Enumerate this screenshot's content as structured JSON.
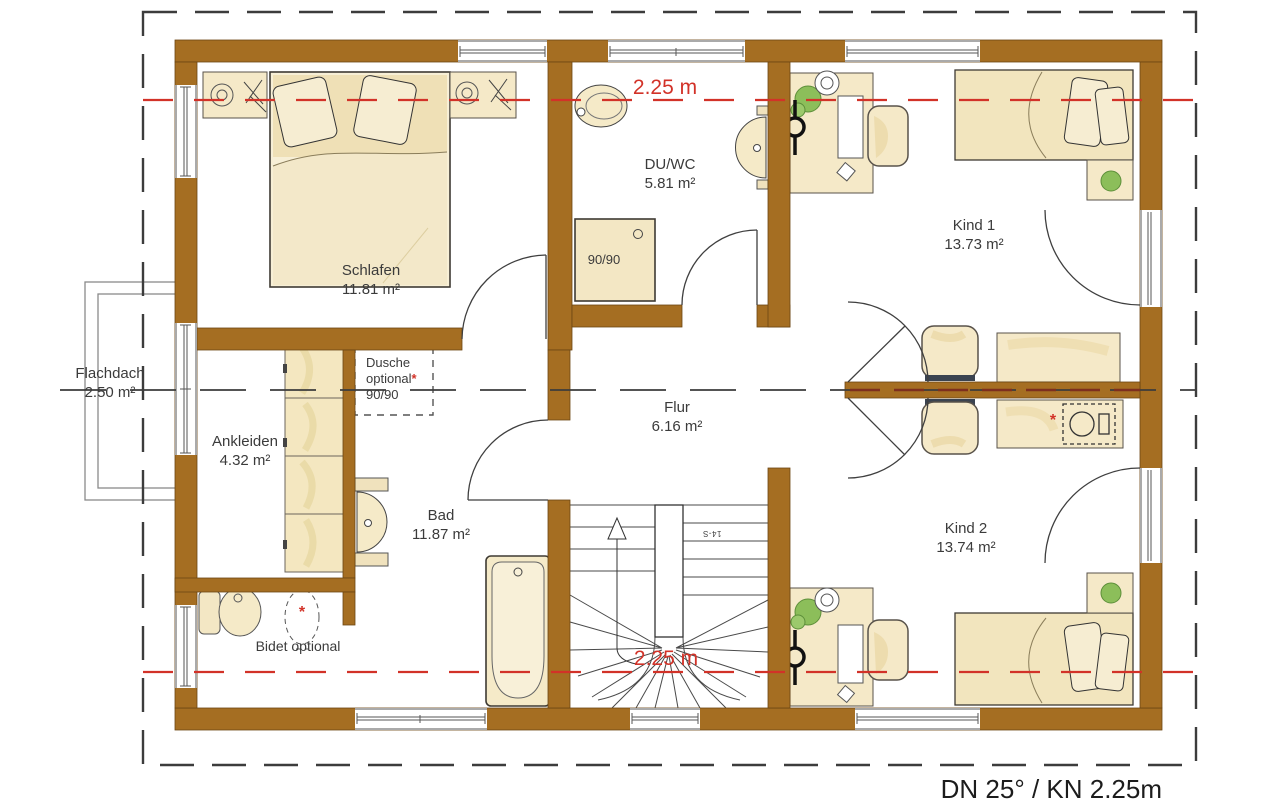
{
  "plan": {
    "footer": "DN 25° / KN 2.25m",
    "knee_wall_top": "2.25 m",
    "knee_wall_bottom": "2.25 m",
    "stair_note": "14-S"
  },
  "rooms": {
    "schlafen": {
      "name": "Schlafen",
      "area": "11.81 m²"
    },
    "duwc": {
      "name": "DU/WC",
      "area": "5.81 m²"
    },
    "kind1": {
      "name": "Kind 1",
      "area": "13.73 m²"
    },
    "kind2": {
      "name": "Kind 2",
      "area": "13.74 m²"
    },
    "flur": {
      "name": "Flur",
      "area": "6.16 m²"
    },
    "bad": {
      "name": "Bad",
      "area": "11.87 m²"
    },
    "ankleiden": {
      "name": "Ankleiden",
      "area": "4.32 m²"
    },
    "flachdach": {
      "name": "Flachdach",
      "area": "2.50 m²"
    }
  },
  "annotations": {
    "dusche_line1": "Dusche",
    "dusche_line2": "optional",
    "dusche_size": "90/90",
    "shower_size": "90/90",
    "bidet": "Bidet optional",
    "asterisk": "*"
  },
  "colors": {
    "wall": "#a56e22",
    "accent_red": "#d23228",
    "furniture": "#f5e9c8",
    "plant": "#8cbe5a"
  }
}
